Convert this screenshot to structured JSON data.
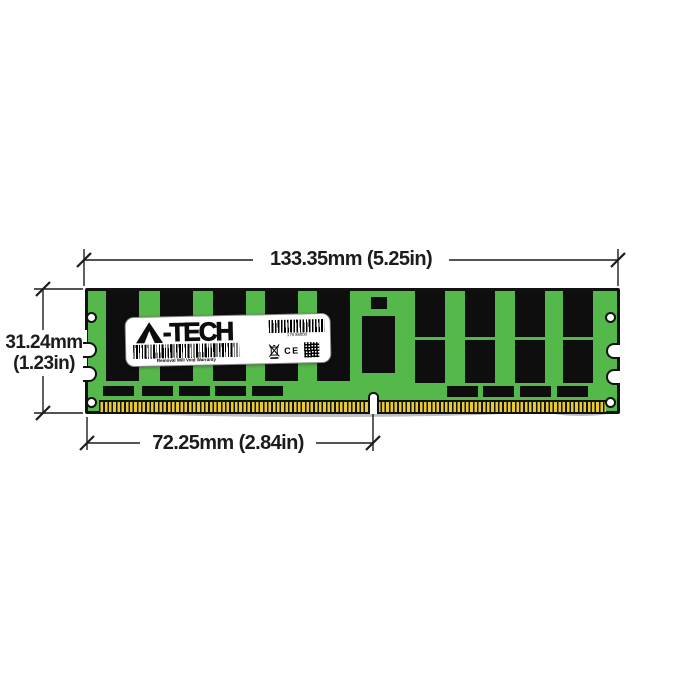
{
  "diagram": {
    "type": "memory-module-dimension-diagram",
    "dims": {
      "width_label": "133.35mm (5.25in)",
      "height_label_mm": "31.24mm",
      "height_label_in": "(1.23in)",
      "contact_span_label": "72.25mm (2.84in)"
    },
    "label": {
      "brand": "A-TECH",
      "logo_suffix": "-TECH",
      "serial": "179 88000",
      "warranty": "Removal Will Void Warranty",
      "ce_mark": "CE"
    },
    "colors": {
      "pcb_green": "#55b84a",
      "pin_gold": "#e9c930",
      "chip_black": "#0e0e0e",
      "line_black": "#1c1c1c"
    }
  }
}
